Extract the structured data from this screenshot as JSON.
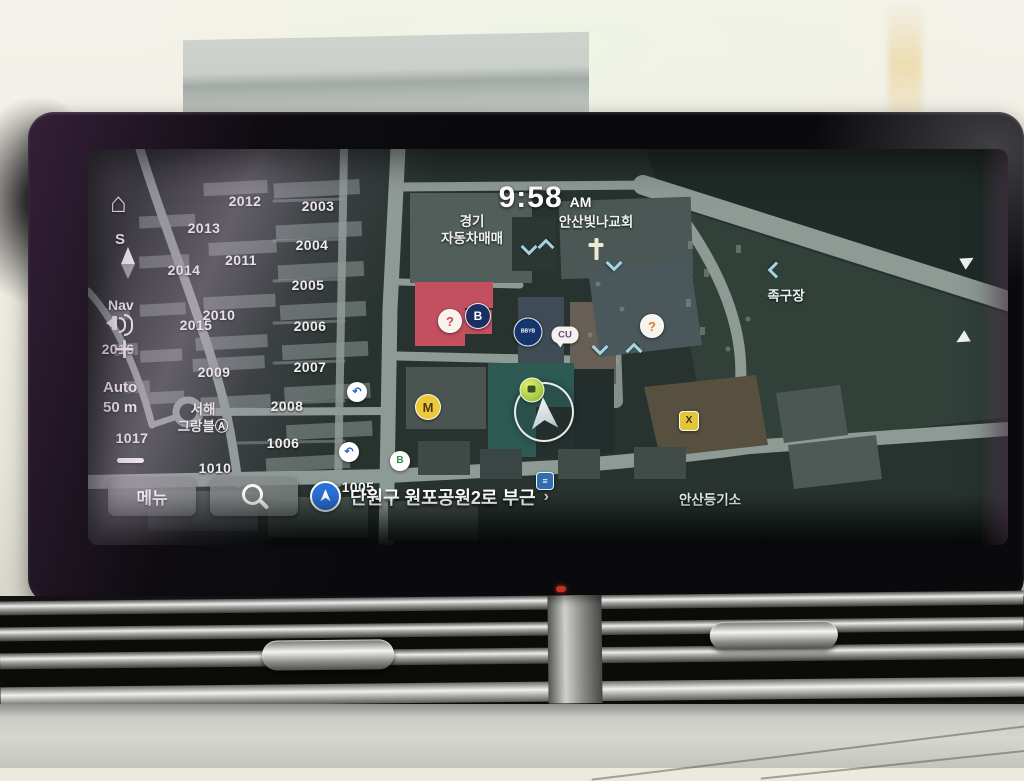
{
  "screen": {
    "clock": {
      "time": "9:58",
      "meridiem": "AM"
    },
    "left_controls": {
      "home_glyph": "⌂",
      "compass_letter": "S",
      "nav_label": "Nav",
      "zoom_in_glyph": "+",
      "zoom_mode": "Auto",
      "zoom_scale": "50 m"
    },
    "bottom_bar": {
      "menu_label": "메뉴",
      "address": "단원구 원포공원2로 부근",
      "chevron": "›"
    },
    "map": {
      "numbers": [
        {
          "t": "2012",
          "x": 157,
          "y": 52
        },
        {
          "t": "2003",
          "x": 230,
          "y": 57
        },
        {
          "t": "2013",
          "x": 116,
          "y": 79
        },
        {
          "t": "2004",
          "x": 224,
          "y": 96
        },
        {
          "t": "2011",
          "x": 153,
          "y": 111
        },
        {
          "t": "2014",
          "x": 96,
          "y": 121
        },
        {
          "t": "2005",
          "x": 220,
          "y": 136
        },
        {
          "t": "2010",
          "x": 131,
          "y": 166
        },
        {
          "t": "2015",
          "x": 108,
          "y": 176
        },
        {
          "t": "2006",
          "x": 222,
          "y": 177
        },
        {
          "t": "2016",
          "x": 30,
          "y": 200
        },
        {
          "t": "2009",
          "x": 126,
          "y": 223
        },
        {
          "t": "2007",
          "x": 222,
          "y": 218
        },
        {
          "t": "2008",
          "x": 199,
          "y": 257
        },
        {
          "t": "1006",
          "x": 195,
          "y": 294
        },
        {
          "t": "1017",
          "x": 44,
          "y": 289
        },
        {
          "t": "1010",
          "x": 127,
          "y": 319
        },
        {
          "t": "1005",
          "x": 270,
          "y": 338
        }
      ],
      "labels": [
        {
          "t": "경기\n자동차매매",
          "x": 384,
          "y": 82
        },
        {
          "t": "안산빛나교회",
          "x": 508,
          "y": 74
        },
        {
          "t": "족구장",
          "x": 698,
          "y": 148
        },
        {
          "t": "서해\n그랑블Ⓐ",
          "x": 115,
          "y": 270
        },
        {
          "t": "안산등기소",
          "x": 622,
          "y": 352
        }
      ],
      "pois": [
        {
          "type": "badge",
          "name": "poi-brand-red",
          "x": 362,
          "y": 172,
          "bg": "#f7f4ee",
          "fg": "#d4434e",
          "glyph": "?",
          "d": 22,
          "fs": 13
        },
        {
          "type": "badge",
          "name": "poi-brand-b",
          "x": 390,
          "y": 167,
          "bg": "#1c2f63",
          "fg": "#ffffff",
          "glyph": "B",
          "d": 24,
          "fs": 12
        },
        {
          "type": "badge",
          "name": "poi-bank",
          "x": 440,
          "y": 183,
          "bg": "#16356e",
          "fg": "#ffffff",
          "glyph": "BBYB",
          "d": 27,
          "fs": 5
        },
        {
          "type": "bubble",
          "name": "poi-cu-store",
          "x": 477,
          "y": 186,
          "text": "CU",
          "fg": "#70468c"
        },
        {
          "type": "badge",
          "name": "poi-brand-orange",
          "x": 564,
          "y": 177,
          "bg": "#f7f4ee",
          "fg": "#e07a22",
          "glyph": "?",
          "d": 22,
          "fs": 13
        },
        {
          "type": "badge",
          "name": "poi-metro-m",
          "x": 340,
          "y": 258,
          "bg": "#ecc83c",
          "fg": "#4a3c10",
          "glyph": "M",
          "d": 24,
          "fs": 13
        },
        {
          "type": "uturn",
          "name": "uturn-marker",
          "x": 269,
          "y": 243
        },
        {
          "type": "uturn",
          "name": "uturn-marker",
          "x": 261,
          "y": 303
        },
        {
          "type": "badge",
          "name": "poi-green-b",
          "x": 312,
          "y": 312,
          "bg": "#ffffff",
          "fg": "#2f8c46",
          "glyph": "B",
          "d": 18,
          "fs": 10
        },
        {
          "type": "badge",
          "name": "poi-sports",
          "x": 601,
          "y": 272,
          "bg": "#e4c43a",
          "fg": "#3a3115",
          "glyph": "X",
          "d": 18,
          "fs": 10,
          "square": true
        },
        {
          "type": "badge",
          "name": "poi-blue-info",
          "x": 457,
          "y": 332,
          "bg": "#2f6fae",
          "fg": "#ffffff",
          "glyph": "≡",
          "d": 16,
          "fs": 9,
          "square": true
        },
        {
          "type": "cross",
          "name": "church-cross-icon",
          "x": 508,
          "y": 100
        }
      ],
      "chevrons": [
        {
          "x": 435,
          "y": 92,
          "dir": "down"
        },
        {
          "x": 452,
          "y": 92,
          "dir": "up"
        },
        {
          "x": 520,
          "y": 108,
          "dir": "down"
        },
        {
          "x": 506,
          "y": 192,
          "dir": "down"
        },
        {
          "x": 540,
          "y": 196,
          "dir": "up"
        },
        {
          "x": 682,
          "y": 115,
          "dir": "left"
        }
      ],
      "edge_arrows": [
        {
          "x": 880,
          "y": 112,
          "rot": -30
        },
        {
          "x": 874,
          "y": 190,
          "rot": 150
        }
      ]
    }
  },
  "colors": {
    "map_bg": "#28332f",
    "road": "#8e9b95",
    "building": "#4c5956",
    "red_building": "#c2505e",
    "teal_building": "#2e5a54",
    "accent_blue": "#2a6fd6",
    "chevron_blue": "#a9dcec"
  }
}
